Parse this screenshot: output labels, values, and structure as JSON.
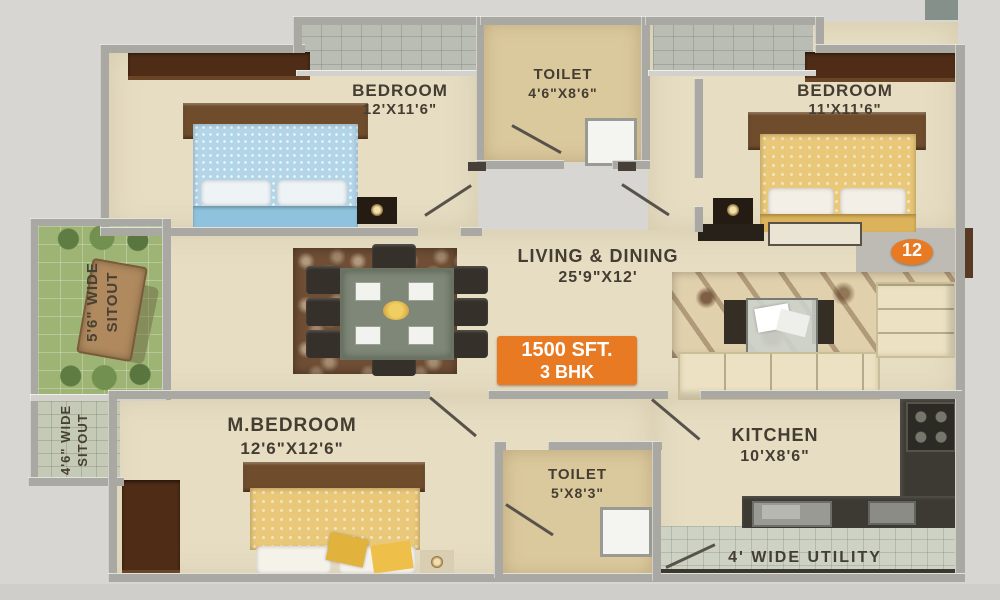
{
  "plan": {
    "unit_number": "12",
    "badge": {
      "area": "1500 SFT.",
      "type": "3 BHK"
    },
    "rooms": {
      "bedroom_top_left": {
        "name": "BEDROOM",
        "dims": "12'X11'6\""
      },
      "toilet_top": {
        "name": "TOILET",
        "dims": "4'6\"X8'6\""
      },
      "bedroom_top_right": {
        "name": "BEDROOM",
        "dims": "11'X11'6\""
      },
      "living_dining": {
        "name": "LIVING & DINING",
        "dims": "25'9\"X12'"
      },
      "sitout_upper": {
        "line1": "5'6\" WIDE",
        "line2": "SITOUT"
      },
      "sitout_lower": {
        "line1": "4'6\" WIDE",
        "line2": "SITOUT"
      },
      "master_bedroom": {
        "name": "M.BEDROOM",
        "dims": "12'6\"X12'6\""
      },
      "toilet_bottom": {
        "name": "TOILET",
        "dims": "5'X8'3\""
      },
      "kitchen": {
        "name": "KITCHEN",
        "dims": "10'X8'6\""
      },
      "utility": {
        "name": "4' WIDE UTILITY"
      }
    },
    "colors": {
      "accent_orange": "#e87a24",
      "wall_grey": "#a9a8a2",
      "floor_beige": "#e6ddc3"
    }
  }
}
